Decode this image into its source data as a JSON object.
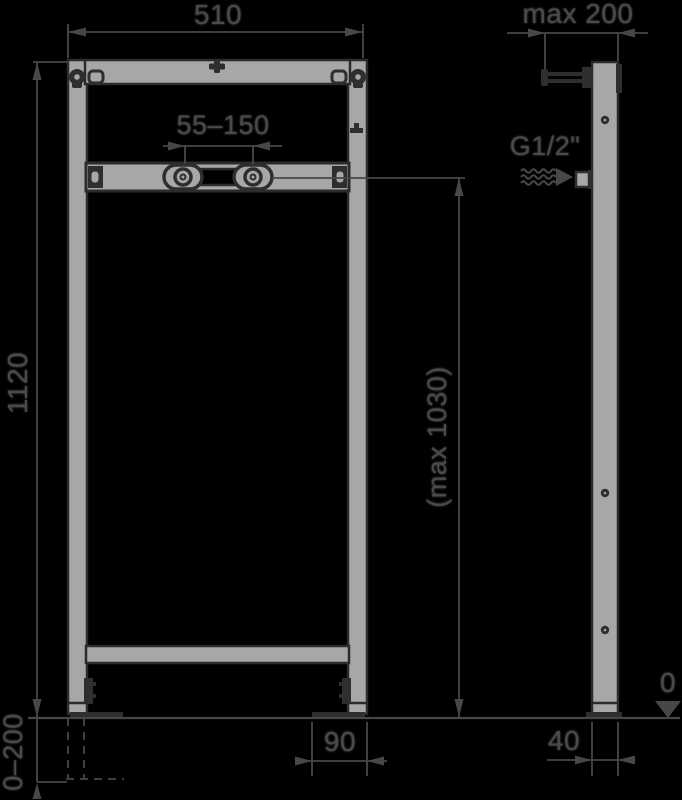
{
  "drawing_type": "installation-frame-technical-drawing",
  "views": {
    "front": "frame front view with tap fixing crossbar",
    "side": "frame side profile with wall bracket and water connection"
  },
  "labels": {
    "frame_width": "510",
    "tap_fixing_spacing": "55–150",
    "frame_height": "1120",
    "connection_height": "(max 1030)",
    "leg_adjustment_range": "0–200",
    "foot_plate_length": "90",
    "profile_depth": "40",
    "wall_bracket_distance": "max 200",
    "floor_level": "0",
    "water_connection_thread": "G1/2\""
  },
  "colors": {
    "background": "#000000",
    "line_ink": "#474747",
    "metal_fill": "#a7a7a7",
    "metal_outline": "#2b2b2b",
    "dark_fitting": "#2e2e2e"
  }
}
